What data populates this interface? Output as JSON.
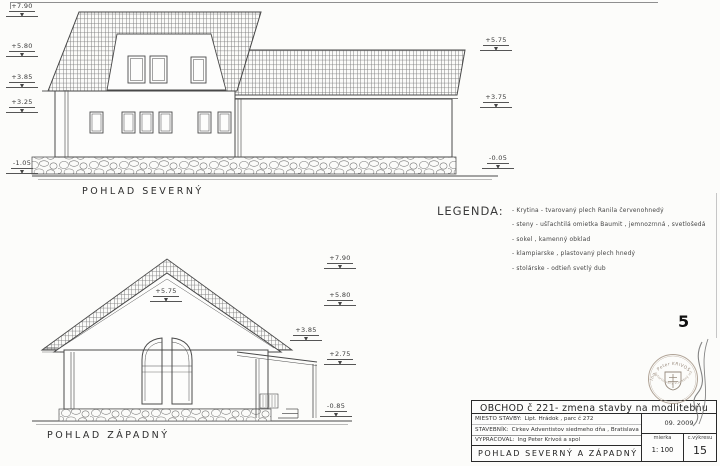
{
  "page": {
    "number": "5"
  },
  "north": {
    "title": "POHLAD SEVERNÝ",
    "marks_left": [
      "+7.90",
      "+5.80",
      "+3.85",
      "+3.25",
      "-1.05"
    ],
    "marks_right": [
      "+5.75",
      "+3.75",
      "-0.05"
    ]
  },
  "west": {
    "title": "POHLAD ZÁPADNÝ",
    "peak_mark": "+5.75",
    "marks_right": [
      "+7.90",
      "+5.80",
      "+3.85",
      "+2.75",
      "-0.85"
    ]
  },
  "legend": {
    "title": "LEGENDA:",
    "items": [
      "- Krytina - tvarovaný plech Ranila  červenohnedý",
      "- steny - ušľachtilá omietka Baumit , jemnozrnná , svetlošedá",
      "- sokel ,  kamenný obklad",
      "-  klampiarske , plastovaný plech hnedý",
      "-  stolárske - odtieň svetlý dub"
    ]
  },
  "titleblock": {
    "project": "OBCHOD č 221-  zmena stavby   na modlitebňu",
    "rows": [
      {
        "label": "MIESTO STAVBY:",
        "value": "Lipt. Hrádok  , parc č  272"
      },
      {
        "label": "STAVEBNÍK:",
        "value": "Cirkev Adventistov siedmeho dňa , Bratislava"
      },
      {
        "label": "VYPRACOVAL:",
        "value": "Ing Peter Krivoš a spol"
      }
    ],
    "drawing_title": "POHLAD  SEVERNÝ  A  ZÁPADNÝ",
    "date": "09. 2009",
    "scale_label": "mierka",
    "scale_value": "1: 100",
    "sheet_label": "c.výkresu",
    "sheet_value": "15"
  },
  "stamp": {
    "name": "Ing. Peter KRIVOŠ",
    "subtitle": "autorizovaný stavebný inžinier"
  }
}
